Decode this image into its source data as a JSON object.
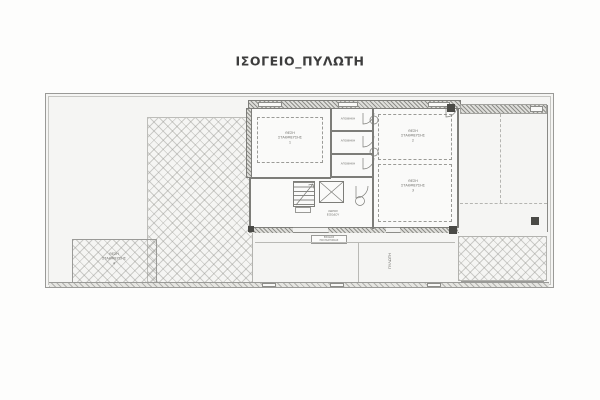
{
  "title": "ΙΣΟΓΕΙΟ_ΠΥΛΩΤΗ",
  "colors": {
    "paper": "#fdfdfc",
    "plot_background": "#f5f5f3",
    "wall_line": "#7d7d79",
    "hatch_line": "#91918c",
    "text": "#6f6f6b",
    "title_text": "#3d3d3d"
  },
  "rooms": {
    "parking1": {
      "l1": "ΘΕΣΗ",
      "l2": "ΣΤΑΘΜΕΥΣΗΣ",
      "num": "1"
    },
    "parking2": {
      "l1": "ΘΕΣΗ",
      "l2": "ΣΤΑΘΜΕΥΣΗΣ",
      "num": "2"
    },
    "parking3": {
      "l1": "ΘΕΣΗ",
      "l2": "ΣΤΑΘΜΕΥΣΗΣ",
      "num": "3"
    },
    "parking4": {
      "l1": "ΘΕΣΗ",
      "l2": "ΣΤΑΘΜΕΥΣΗΣ",
      "num": "4"
    },
    "storage1": {
      "label": "ΑΠΟΘΗΚΗ"
    },
    "storage2": {
      "label": "ΑΠΟΘΗΚΗ"
    },
    "storage3": {
      "label": "ΑΠΟΘΗΚΗ"
    },
    "entry_hall": {
      "l1": "ΧΩΡΟΣ",
      "l2": "ΕΙΣΟΔΟΥ"
    },
    "piloti": {
      "label": "ΠΥΛΩΤΗ"
    }
  },
  "entrance_sign": {
    "l1": "ΕΙΣΟΔΟΣ",
    "l2": "ΠΟΛΥΚΑΤΟΙΚΙΑΣ"
  }
}
